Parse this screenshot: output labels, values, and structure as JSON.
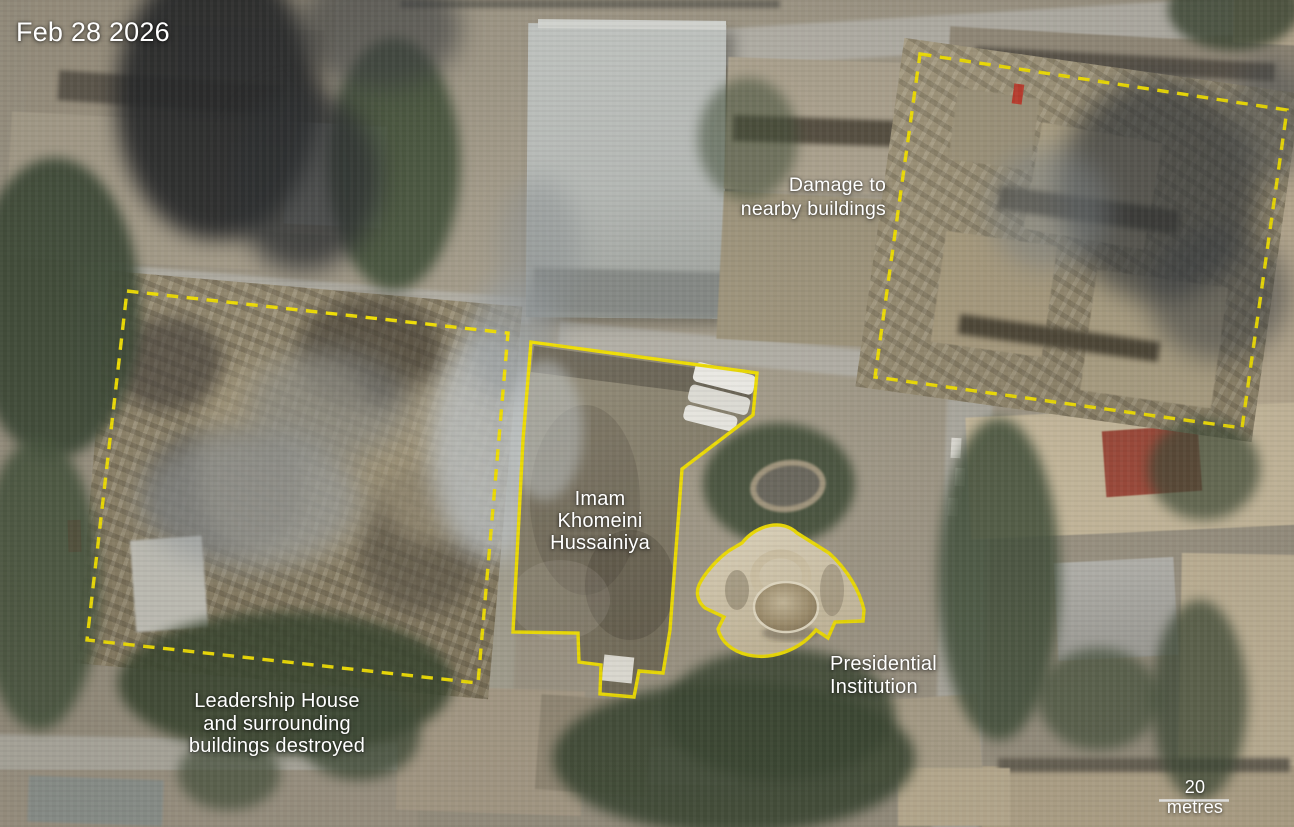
{
  "date_label": "Feb 28 2026",
  "annotations": {
    "damage_nearby": {
      "label": "Damage to\nnearby buildings",
      "style": "dashed-outline"
    },
    "hussainiya": {
      "label": "Imam\nKhomeini\nHussainiya",
      "style": "solid-outline"
    },
    "presidential": {
      "label": "Presidential\nInstitution",
      "style": "solid-outline"
    },
    "leadership_house": {
      "label": "Leadership House\nand surrounding\nbuildings destroyed",
      "style": "dashed-outline"
    }
  },
  "scale_bar": {
    "label": "20 metres"
  },
  "colors": {
    "annotation_yellow": "#f8e600",
    "label_text": "#ffffff",
    "scale_bar_line": "#ffffff"
  }
}
